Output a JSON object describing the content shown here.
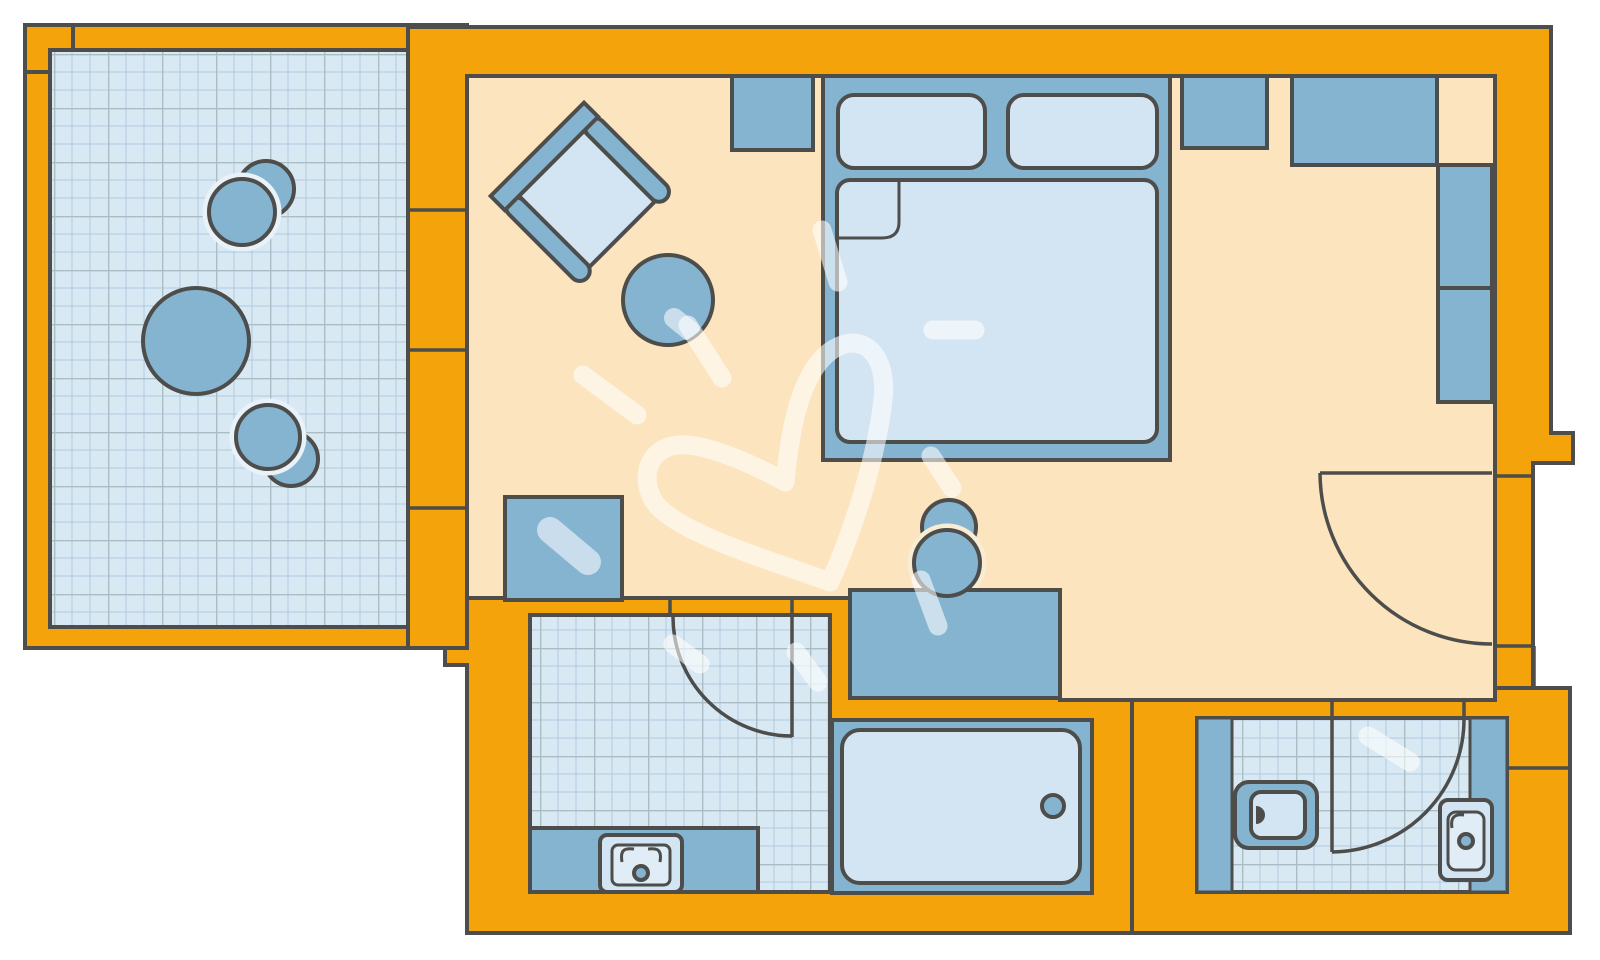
{
  "meta": {
    "title": "Hotel room floor plan",
    "view": "top-down architectural drawing",
    "visible_text": "none"
  },
  "palette": {
    "exterior": "#ffffff",
    "wall": "#F4A40A",
    "line": "#4D4D4B",
    "floor": "#FBE4BE",
    "tile": "#D9E9F4",
    "tileminor": "#AECBDF",
    "tilemajor": "#A9BDC2",
    "furniture": "#85B4D1",
    "lightfill": "#D3E5F3",
    "basin": "#E0EDF6",
    "halo": "#E9F2F8",
    "creamhalo": "#F8ECD2",
    "watermark": "rgba(255,255,255,0.58)",
    "blob": "#C9DDEC"
  },
  "rooms": [
    {
      "id": "balcony",
      "name": "Balcony terrace",
      "floor": "tiled grid",
      "furniture": [
        "chair (seat + backrest)",
        "chair (seat + backrest)",
        "round table"
      ]
    },
    {
      "id": "bedroom",
      "name": "Bedroom / living room",
      "floor": "plain",
      "furniture": [
        "armchair (rotated 45°)",
        "round side table",
        "tv sideboard",
        "double bed with two pillows and folded blanket",
        "nightstand",
        "wardrobe",
        "wall shelf unit",
        "wall shelf unit",
        "minibar cabinet",
        "desk / dressing table",
        "stool (seat + backrest)"
      ]
    },
    {
      "id": "bathroom",
      "name": "Bathroom",
      "floor": "tiled grid",
      "furniture": [
        "vanity counter",
        "washbasin with drain",
        "bathtub with drain"
      ]
    },
    {
      "id": "wc",
      "name": "Toilet room",
      "floor": "tiled grid",
      "furniture": [
        "toilet",
        "washbasin with drain",
        "side panel",
        "side panel"
      ]
    }
  ],
  "doors": [
    {
      "id": "bathroom-door",
      "type": "swing door with quarter-circle arc"
    },
    {
      "id": "wc-door",
      "type": "swing door with quarter-circle arc"
    },
    {
      "id": "entry-door",
      "type": "swing door with quarter-circle arc"
    }
  ],
  "watermark": {
    "motif": "hand-drawn heart with sun rays and paint daubs",
    "color": "translucent white"
  }
}
